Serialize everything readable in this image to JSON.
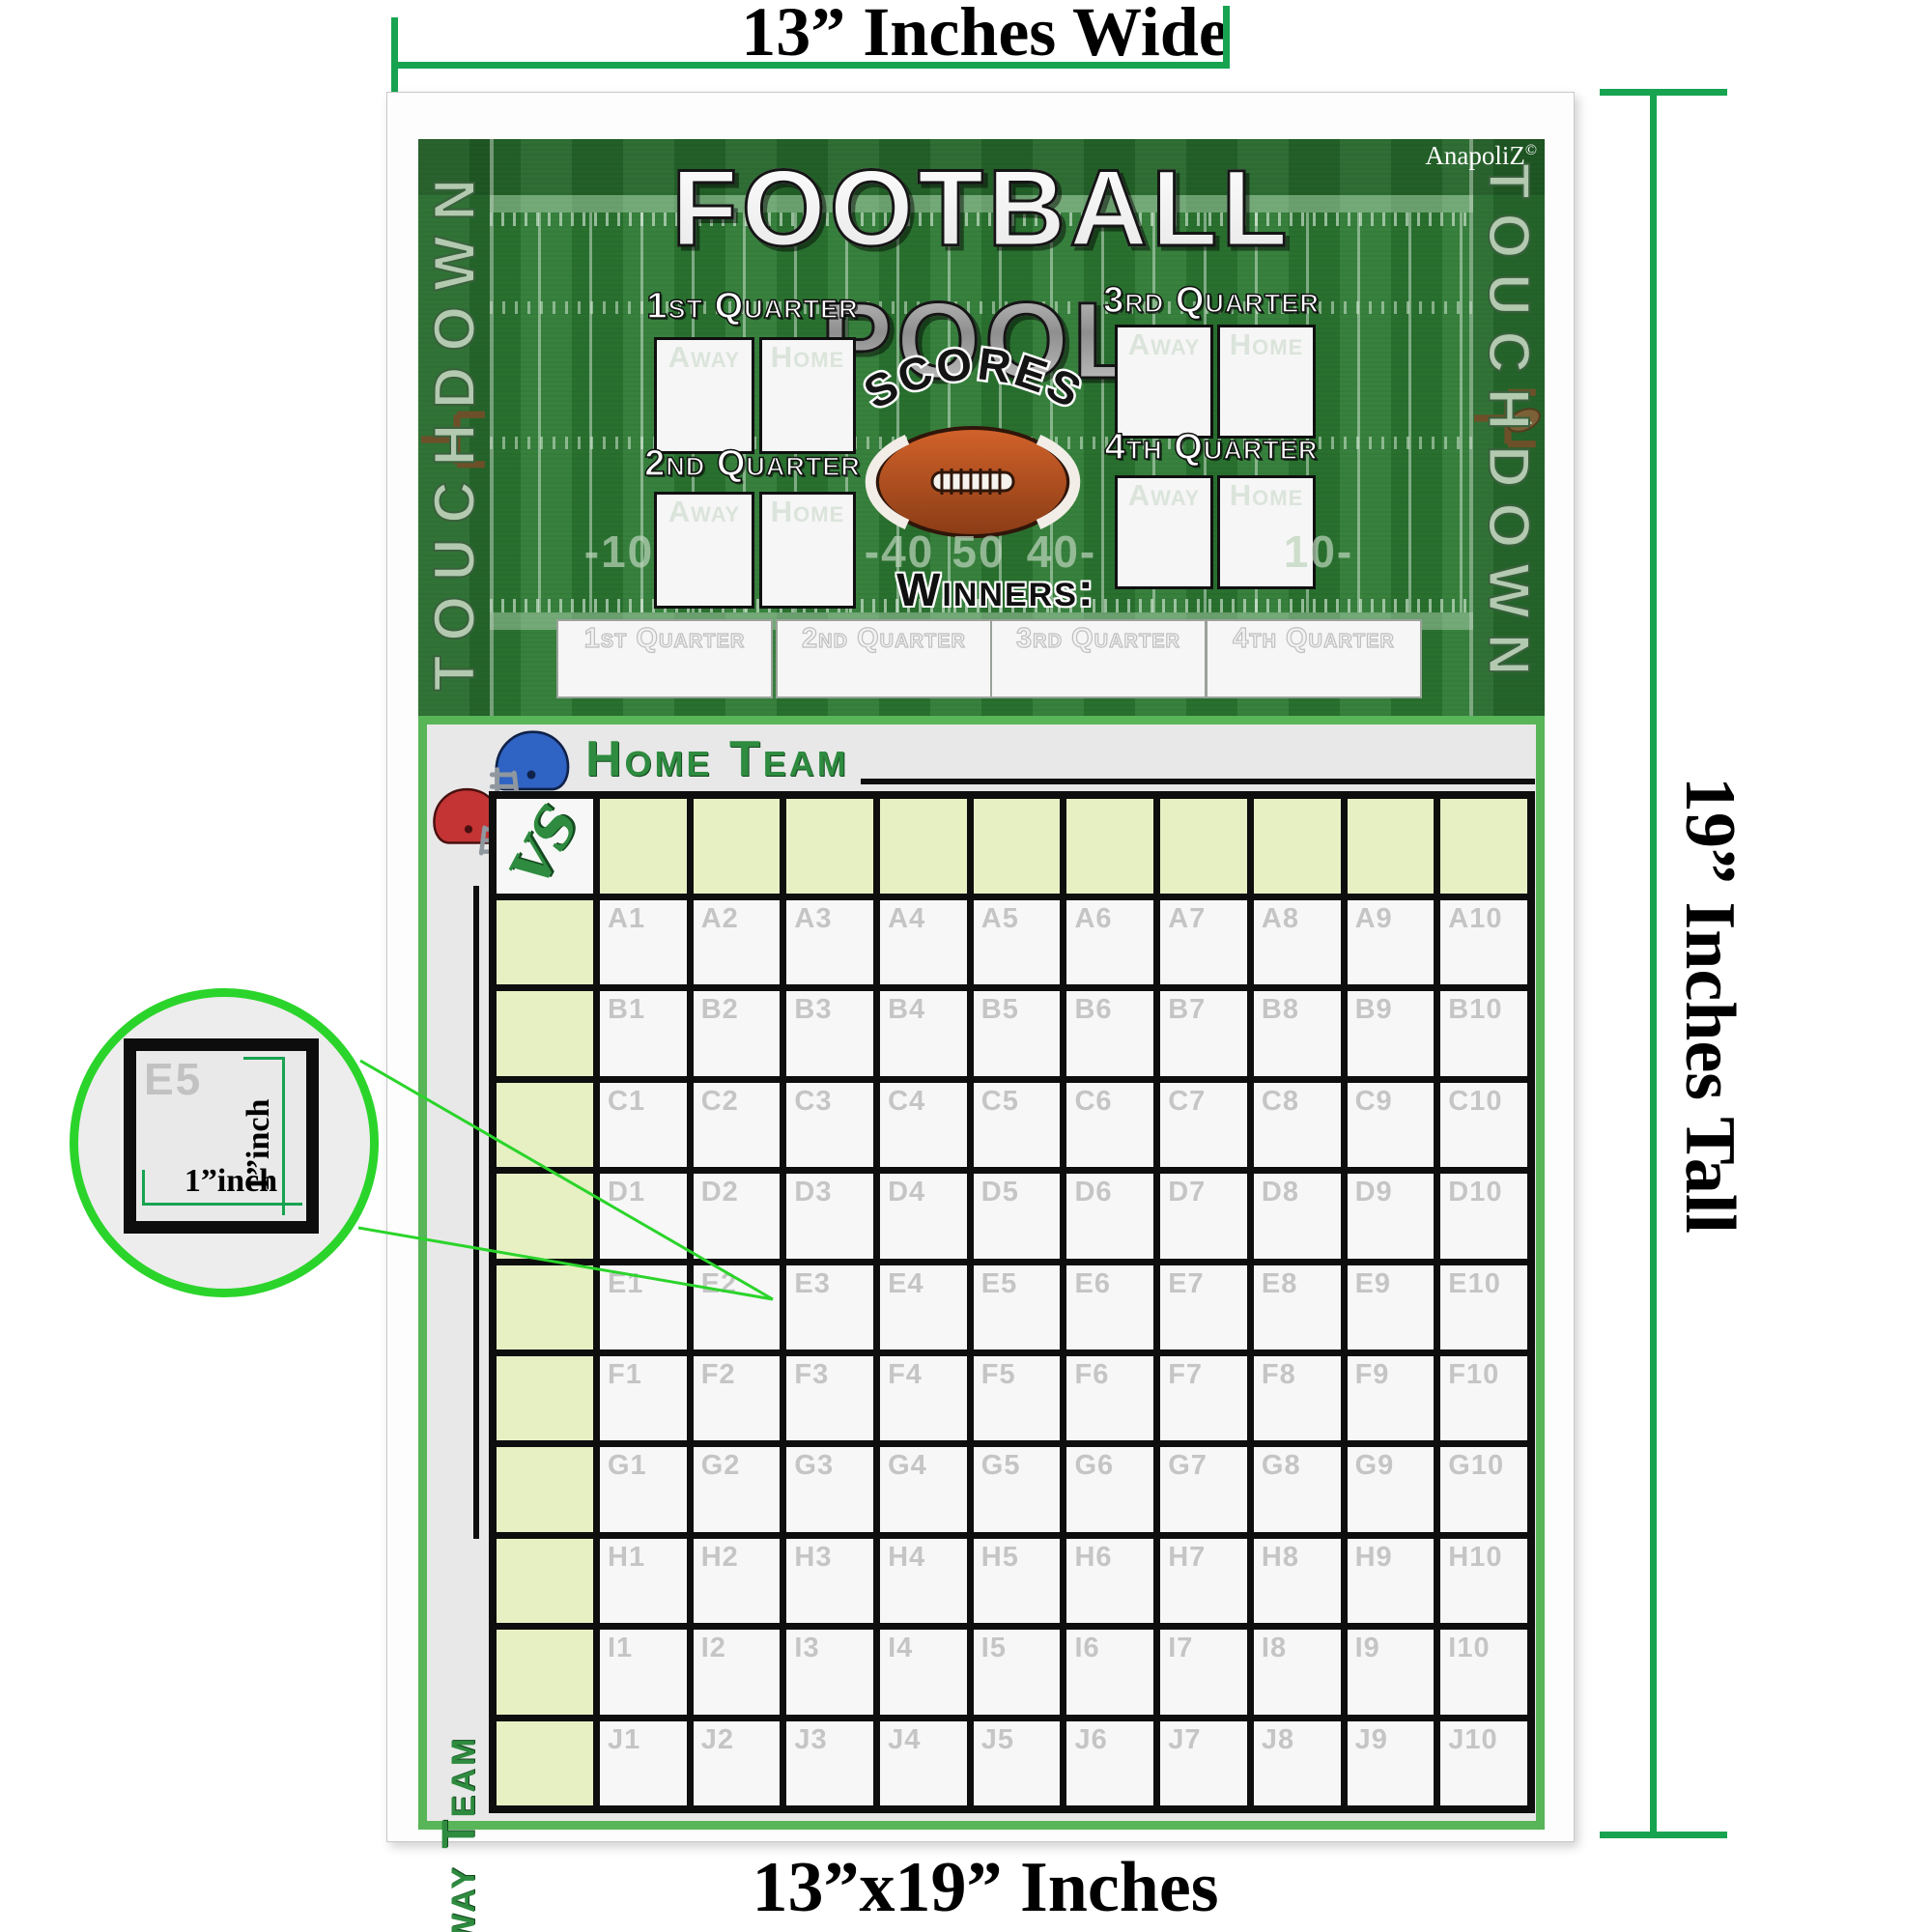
{
  "dimensions": {
    "top_label": "13” Inches Wide",
    "right_label": "19” Inches Tall",
    "bottom_label": "13”x19” Inches"
  },
  "brand": {
    "name": "AnapoliZ",
    "mark": "©"
  },
  "field": {
    "title": "FOOTBALL POOL",
    "touchdown_left": "TOUCHDOWN",
    "touchdown_right": "TOUCHDOWN",
    "scores_label": "SCORES",
    "winners_label": "Winners:",
    "yard_numbers": [
      "-10",
      "-40",
      "50",
      "40-",
      "10-"
    ],
    "quarters": [
      {
        "label": "1st Quarter",
        "away_label": "Away",
        "home_label": "Home"
      },
      {
        "label": "2nd Quarter",
        "away_label": "Away",
        "home_label": "Home"
      },
      {
        "label": "3rd Quarter",
        "away_label": "Away",
        "home_label": "Home"
      },
      {
        "label": "4th Quarter",
        "away_label": "Away",
        "home_label": "Home"
      }
    ],
    "winner_boxes": [
      "1st Quarter",
      "2nd Quarter",
      "3rd Quarter",
      "4th Quarter"
    ]
  },
  "pool": {
    "home_team_label": "Home Team",
    "away_team_label": "Away Team",
    "vs_label": "VS",
    "row_letters": [
      "A",
      "B",
      "C",
      "D",
      "E",
      "F",
      "G",
      "H",
      "I",
      "J"
    ],
    "column_count": 10,
    "cells": [
      [
        "A1",
        "A2",
        "A3",
        "A4",
        "A5",
        "A6",
        "A7",
        "A8",
        "A9",
        "A10"
      ],
      [
        "B1",
        "B2",
        "B3",
        "B4",
        "B5",
        "B6",
        "B7",
        "B8",
        "B9",
        "B10"
      ],
      [
        "C1",
        "C2",
        "C3",
        "C4",
        "C5",
        "C6",
        "C7",
        "C8",
        "C9",
        "C10"
      ],
      [
        "D1",
        "D2",
        "D3",
        "D4",
        "D5",
        "D6",
        "D7",
        "D8",
        "D9",
        "D10"
      ],
      [
        "E1",
        "E2",
        "E3",
        "E4",
        "E5",
        "E6",
        "E7",
        "E8",
        "E9",
        "E10"
      ],
      [
        "F1",
        "F2",
        "F3",
        "F4",
        "F5",
        "F6",
        "F7",
        "F8",
        "F9",
        "F10"
      ],
      [
        "G1",
        "G2",
        "G3",
        "G4",
        "G5",
        "G6",
        "G7",
        "G8",
        "G9",
        "G10"
      ],
      [
        "H1",
        "H2",
        "H3",
        "H4",
        "H5",
        "H6",
        "H7",
        "H8",
        "H9",
        "H10"
      ],
      [
        "I1",
        "I2",
        "I3",
        "I4",
        "I5",
        "I6",
        "I7",
        "I8",
        "I9",
        "I10"
      ],
      [
        "J1",
        "J2",
        "J3",
        "J4",
        "J5",
        "J6",
        "J7",
        "J8",
        "J9",
        "J10"
      ]
    ]
  },
  "magnifier": {
    "cell_label": "E5",
    "width_label": "1”inch",
    "height_label": "1”inch"
  },
  "colors": {
    "measure_green": "#18a351",
    "magnifier_green": "#2bd42b",
    "field_green": "#2c7a33",
    "team_green": "#2e8b3f",
    "header_cell_green": "#e6f0c3"
  }
}
